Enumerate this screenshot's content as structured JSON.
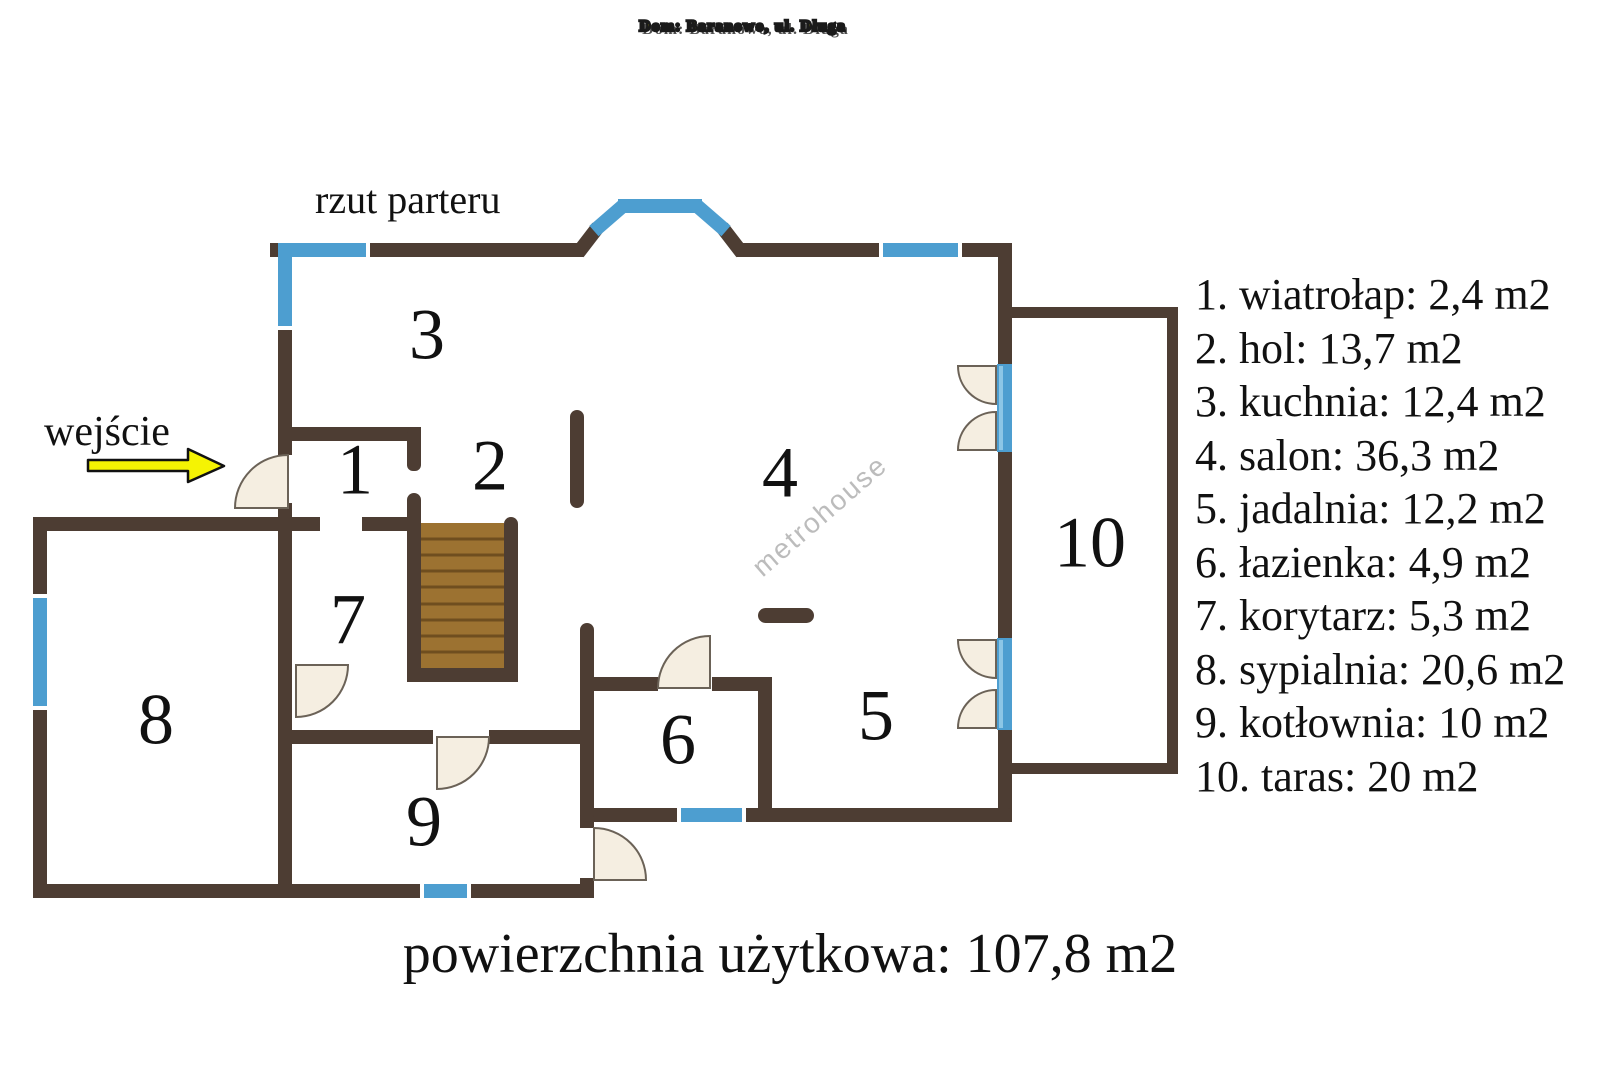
{
  "title": "Dom: Baranowo, ul. Długa",
  "plan": {
    "label": "rzut parteru",
    "entrance_label": "wejście",
    "watermark": "metrohouse",
    "room_numbers": [
      "1",
      "2",
      "3",
      "4",
      "5",
      "6",
      "7",
      "8",
      "9",
      "10"
    ]
  },
  "legend": {
    "items": [
      "1. wiatrołap: 2,4 m2",
      "2. hol: 13,7 m2",
      "3. kuchnia: 12,4 m2",
      "4. salon: 36,3 m2",
      "5. jadalnia: 12,2 m2",
      "6. łazienka: 4,9 m2",
      "7. korytarz: 5,3 m2",
      "8. sypialnia: 20,6 m2",
      "9. kotłownia: 10 m2",
      "10. taras: 20 m2"
    ]
  },
  "footer": {
    "text": "powierzchnia użytkowa: 107,8 m2"
  },
  "colors": {
    "bg": "#ffffff",
    "text": "#111111",
    "wall": "#4d3d33",
    "window": "#4d9ed0",
    "window-light": "#8cc6e6",
    "wood": "#9c7231",
    "wood-line": "#6f4e1f",
    "door": "#f5eee1",
    "door-stroke": "#6b6257",
    "title": "#ffff00",
    "title-outline": "#1a1a1a",
    "arrow": "#f5f303",
    "watermark": "#bcbcbc"
  }
}
